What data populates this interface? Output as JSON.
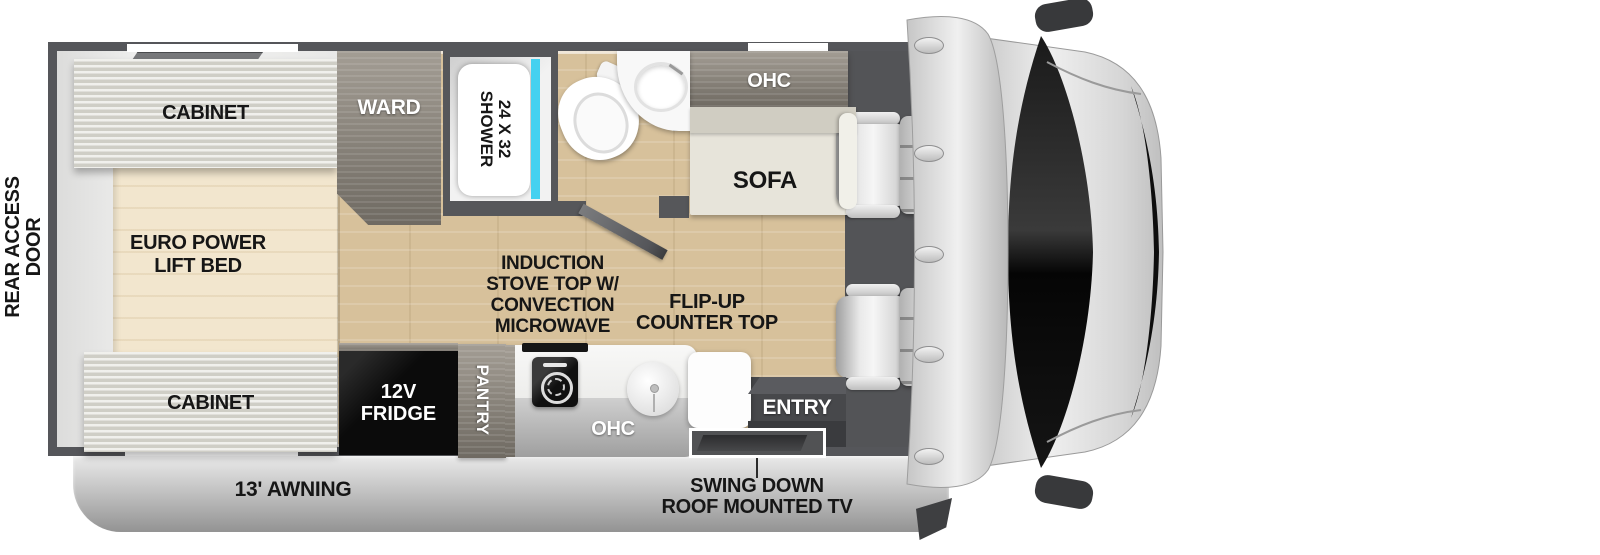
{
  "rear_access": {
    "line1": "REAR ACCESS",
    "line2": "DOOR"
  },
  "bedroom": {
    "cabinet_top": "CABINET",
    "bed_line1": "EURO POWER",
    "bed_line2": "LIFT BED",
    "cabinet_bottom": "CABINET"
  },
  "ward": "WARD",
  "bathroom": {
    "shower_line1": "24 X 32",
    "shower_line2": "SHOWER"
  },
  "living": {
    "ohc": "OHC",
    "sofa": "SOFA"
  },
  "kitchen": {
    "line1": "INDUCTION",
    "line2": "STOVE TOP W/",
    "line3": "CONVECTION",
    "line4": "MICROWAVE",
    "flip1": "FLIP-UP",
    "flip2": "COUNTER TOP",
    "fridge1": "12V",
    "fridge2": "FRIDGE",
    "pantry": "PANTRY",
    "ohc": "OHC"
  },
  "entry": "ENTRY",
  "exterior": {
    "awning": "13' AWNING",
    "tv_line1": "SWING DOWN",
    "tv_line2": "ROOF MOUNTED TV"
  },
  "colors": {
    "wall": "#55565a",
    "wood_floor": "#d7c19b",
    "bed_wood": "#f2e6ce",
    "shower_glass": "#45d1f0",
    "fridge": "#0c0c0c",
    "windshield": "#141414",
    "awning": "#c2c2c2"
  }
}
